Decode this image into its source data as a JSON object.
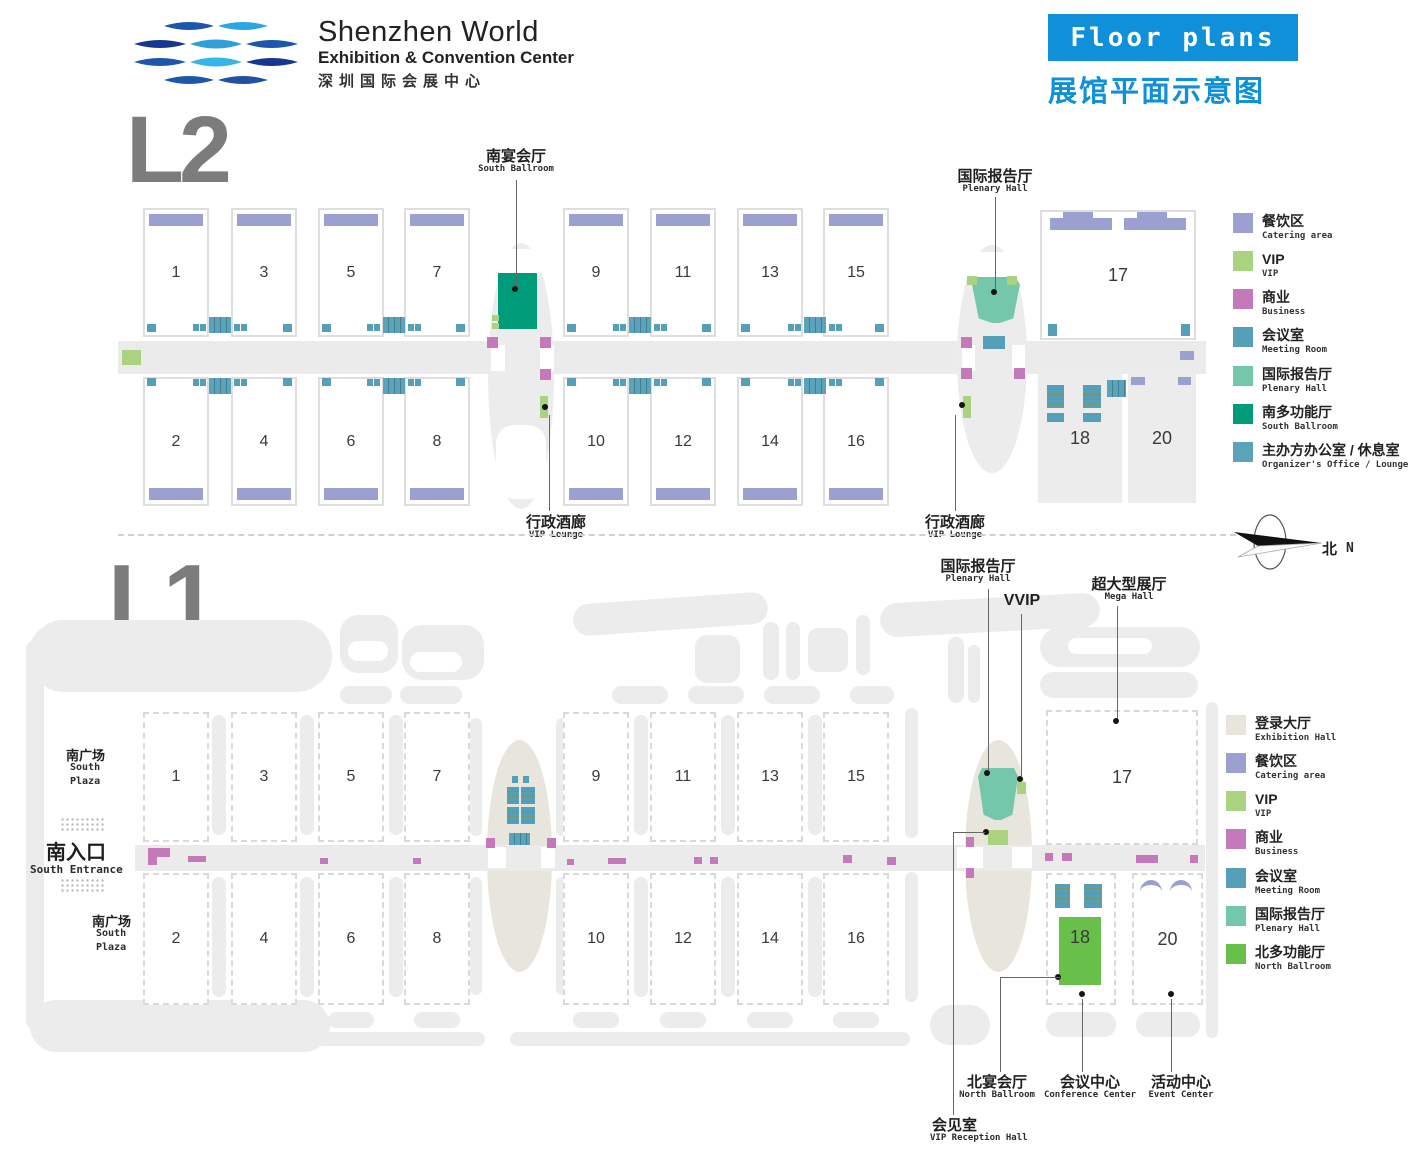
{
  "header": {
    "brand_title": "Shenzhen World",
    "brand_subtitle": "Exhibition & Convention Center",
    "brand_cn": "深圳国际会展中心",
    "banner": "Floor plans",
    "banner_cn": "展馆平面示意图"
  },
  "compass": {
    "cn": "北",
    "en": "N"
  },
  "colors": {
    "accent_blue": "#0f90d8",
    "catering": "#9ba0d1",
    "vip": "#a9d37f",
    "business": "#c579bb",
    "meeting_room": "#559fb9",
    "plenary": "#74c7ab",
    "south_ballroom": "#009b79",
    "organizer": "#5aa3bb",
    "exhibition_hall": "#e8e5dc",
    "north_ballroom": "#68bf4a"
  },
  "l2": {
    "heading": "L2",
    "halls_top": [
      "1",
      "3",
      "5",
      "7",
      "9",
      "11",
      "13",
      "15"
    ],
    "halls_bottom": [
      "2",
      "4",
      "6",
      "8",
      "10",
      "12",
      "14",
      "16"
    ],
    "hall_17": "17",
    "hall_18": "18",
    "hall_20": "20",
    "labels": {
      "south_ballroom": {
        "cn": "南宴会厅",
        "en": "South Ballroom"
      },
      "plenary": {
        "cn": "国际报告厅",
        "en": "Plenary Hall"
      },
      "vip_lounge_left": {
        "cn": "行政酒廊",
        "en": "VIP Lounge"
      },
      "vip_lounge_right": {
        "cn": "行政酒廊",
        "en": "VIP Lounge"
      }
    },
    "legend": [
      {
        "cn": "餐饮区",
        "en": "Catering area",
        "color": "#9ba0d1"
      },
      {
        "cn": "VIP",
        "en": "VIP",
        "color": "#a9d37f"
      },
      {
        "cn": "商业",
        "en": "Business",
        "color": "#c579bb"
      },
      {
        "cn": "会议室",
        "en": "Meeting Room",
        "color": "#559fb9"
      },
      {
        "cn": "国际报告厅",
        "en": "Plenary Hall",
        "color": "#74c7ab"
      },
      {
        "cn": "南多功能厅",
        "en": "South Ballroom",
        "color": "#009b79"
      },
      {
        "cn": "主办方办公室 / 休息室",
        "en": "Organizer's Office / Lounge",
        "color": "#5aa3bb"
      }
    ]
  },
  "l1": {
    "heading": "L1",
    "halls_top": [
      "1",
      "3",
      "5",
      "7",
      "9",
      "11",
      "13",
      "15"
    ],
    "halls_bottom": [
      "2",
      "4",
      "6",
      "8",
      "10",
      "12",
      "14",
      "16"
    ],
    "hall_17": "17",
    "hall_18": "18",
    "hall_20": "20",
    "labels": {
      "plenary": {
        "cn": "国际报告厅",
        "en": "Plenary Hall"
      },
      "vvip": "VVIP",
      "mega": {
        "cn": "超大型展厅",
        "en": "Mega Hall"
      },
      "south_plaza_top": {
        "cn": "南广场",
        "en1": "South",
        "en2": "Plaza"
      },
      "south_plaza_bottom": {
        "cn": "南广场",
        "en1": "South",
        "en2": "Plaza"
      },
      "south_entrance": {
        "cn": "南入口",
        "en": "South Entrance"
      },
      "north_ballroom": {
        "cn": "北宴会厅",
        "en": "North Ballroom"
      },
      "conference": {
        "cn": "会议中心",
        "en": "Conference Center"
      },
      "event": {
        "cn": "活动中心",
        "en": "Event Center"
      },
      "vip_reception": {
        "cn": "会见室",
        "en": "VIP Reception Hall"
      }
    },
    "legend": [
      {
        "cn": "登录大厅",
        "en": "Exhibition Hall",
        "color": "#e8e5dc"
      },
      {
        "cn": "餐饮区",
        "en": "Catering area",
        "color": "#9ba0d1"
      },
      {
        "cn": "VIP",
        "en": "VIP",
        "color": "#a9d37f"
      },
      {
        "cn": "商业",
        "en": "Business",
        "color": "#c579bb"
      },
      {
        "cn": "会议室",
        "en": "Meeting Room",
        "color": "#559fb9"
      },
      {
        "cn": "国际报告厅",
        "en": "Plenary Hall",
        "color": "#74c7ab"
      },
      {
        "cn": "北多功能厅",
        "en": "North Ballroom",
        "color": "#68bf4a"
      }
    ]
  }
}
